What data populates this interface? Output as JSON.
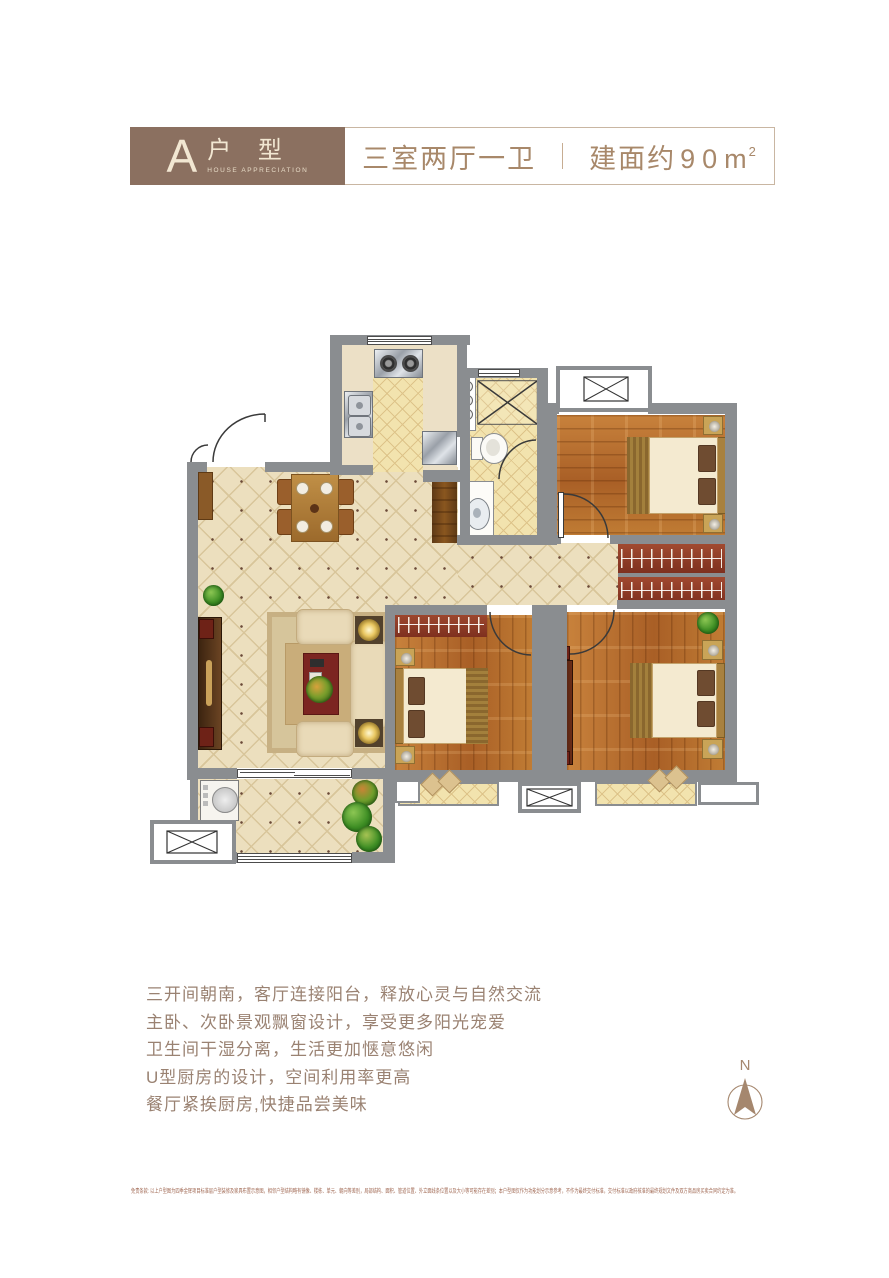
{
  "header": {
    "type_letter": "A",
    "type_label": "户 型",
    "type_caption": "HOUSE APPRECIATION",
    "layout_text": "三室两厅一卫",
    "area_prefix": "建面约",
    "area_number": "90",
    "area_unit": "m",
    "area_exponent": "2"
  },
  "features": {
    "lines": [
      "三开间朝南，客厅连接阳台，释放心灵与自然交流",
      "主卧、次卧景观飘窗设计，享受更多阳光宠爱",
      "卫生间干湿分离，生活更加惬意悠闲",
      "U型厨房的设计，空间利用率更高",
      "餐厅紧挨厨房,快捷品尝美味"
    ]
  },
  "compass": {
    "north_label": "N"
  },
  "disclaimer": {
    "text": "免责条款: 以上户型图为四季金辉项目标准层户型装修及家具布置示意图，相邻户型结构略有镜像、楼栋、单元、朝向等差别，局部结构、面积、管道位置、外立面线条位置以及大小等可能存在差别；本户型图仅作为功能划分示意参考，不作为最终交付标准，交付标准以政府核准的最终规划文件及双方商品房买卖合同约定为准。"
  },
  "colors": {
    "header_brown": "#8b7060",
    "header_text_cream": "#f2e7d2",
    "accent_text_brown": "#a8886a",
    "body_text_brown": "#9a8272",
    "disclaimer_brown": "#a26b56",
    "wall_gray": "#8a8d90",
    "tile_cream": "#ecdfbe",
    "bath_tile_yellow": "#f2e3ae",
    "wood_floor_orange": "#b9712f",
    "wardrobe_red": "#8e3c2b",
    "compass_tan": "#a5876e"
  }
}
